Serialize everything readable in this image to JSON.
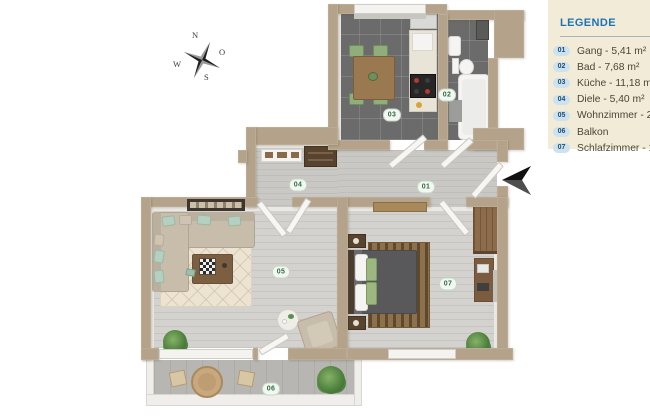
{
  "legend": {
    "title": "LEGENDE",
    "items": [
      {
        "num": "01",
        "label": "Gang - 5,41 m²"
      },
      {
        "num": "02",
        "label": "Bad - 7,68 m²"
      },
      {
        "num": "03",
        "label": "Küche - 11,18 m²"
      },
      {
        "num": "04",
        "label": "Diele - 5,40 m²"
      },
      {
        "num": "05",
        "label": "Wohnzimmer - 25"
      },
      {
        "num": "06",
        "label": "Balkon"
      },
      {
        "num": "07",
        "label": "Schlafzimmer - 19"
      }
    ],
    "colors": {
      "bg": "#f1ebd8",
      "title": "#1b74b8",
      "badge_bg": "#cde2ec",
      "badge_text": "#1e4d78",
      "text": "#4b4637"
    }
  },
  "compass": {
    "n": "N",
    "o": "O",
    "s": "S",
    "w": "W"
  },
  "plan": {
    "room_labels": [
      {
        "id": "01"
      },
      {
        "id": "02"
      },
      {
        "id": "03"
      },
      {
        "id": "04"
      },
      {
        "id": "05"
      },
      {
        "id": "06"
      },
      {
        "id": "07"
      }
    ],
    "colors": {
      "wall": "#b4a38a",
      "floor_tile_dark": "#6b6b6b",
      "floor_wood_light": "#d3d2cf",
      "floor_hall": "#c9c8c5",
      "floor_balcony": "#b7b6b2",
      "room_badge_text": "#2e6b3f"
    }
  }
}
